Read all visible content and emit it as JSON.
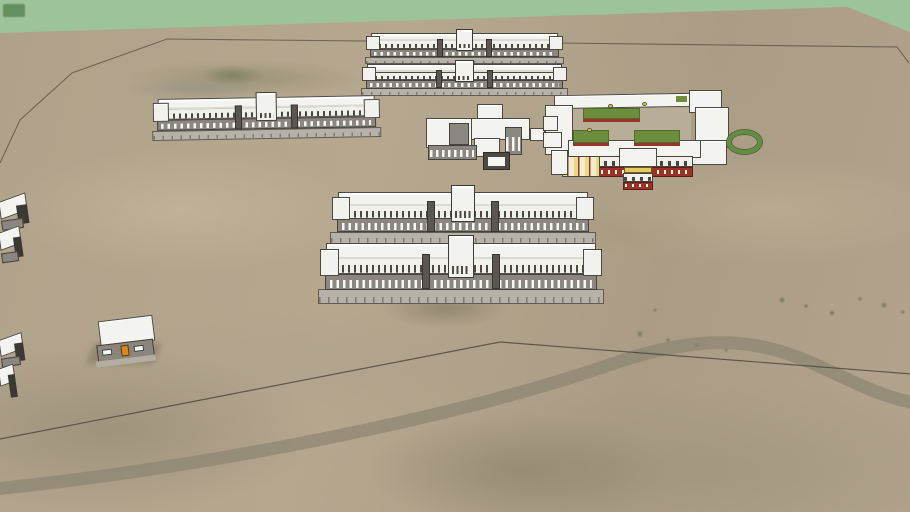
{
  "app": {
    "name": "3D model viewer viewport",
    "view": "aerial perspective of a campus model on satellite terrain"
  },
  "scene": {
    "visible_text": "none",
    "objects": [
      {
        "id": "background-plane",
        "label": "flat green ground plane"
      },
      {
        "id": "grass-patch-dark-1",
        "label": "dark green patch, top-left corner"
      },
      {
        "id": "grass-patch-dark-2",
        "label": "dark green patch, left edge"
      },
      {
        "id": "terrain",
        "label": "sandy satellite-textured terrain"
      },
      {
        "id": "boundary-line-upper",
        "label": "thin site boundary edge across upper terrain"
      },
      {
        "id": "boundary-line-lower",
        "label": "thin site boundary edge across lower terrain"
      },
      {
        "id": "road",
        "label": "dirt road crossing lower terrain"
      },
      {
        "id": "north-dorm-1",
        "label": "long two-story block with center tower"
      },
      {
        "id": "north-dorm-2",
        "label": "long two-story block with center tower"
      },
      {
        "id": "west-block",
        "label": "long two-story block with center tower"
      },
      {
        "id": "central-building",
        "label": "H-shaped white flat-roof building"
      },
      {
        "id": "courtyard-complex",
        "label": "courtyard classroom complex with lawns, red base and yellow arcade"
      },
      {
        "id": "traffic-circle",
        "label": "green ring planter"
      },
      {
        "id": "mid-dorm-1",
        "label": "long two-story block with center tower"
      },
      {
        "id": "mid-dorm-2",
        "label": "long two-story block with center tower"
      },
      {
        "id": "small-house",
        "label": "small house with orange door"
      },
      {
        "id": "edge-building-1",
        "label": "partially visible building at left edge"
      },
      {
        "id": "edge-building-2",
        "label": "partially visible building at left edge"
      },
      {
        "id": "edge-building-3",
        "label": "partially visible building at left edge"
      },
      {
        "id": "edge-building-4",
        "label": "partially visible building at left edge"
      }
    ]
  },
  "colors": {
    "background_green": "#9dc39b",
    "dark_green_patch": "#649060",
    "terrain_tan": "#b3a48c",
    "road_gray": "#8c8472",
    "edge_line": "#433d31",
    "roof_white": "#f3f3f0",
    "wall_gray": "#8b867f",
    "wall_dark": "#4e4a43",
    "window_white": "#f6f6f3",
    "terrace_gray": "#b7b2a8",
    "accent_red": "#993325",
    "lawn_green": "#6b8e3d",
    "accent_yellow": "#e4c95c",
    "door_orange": "#d6891e",
    "ring_green": "#5f9040"
  }
}
